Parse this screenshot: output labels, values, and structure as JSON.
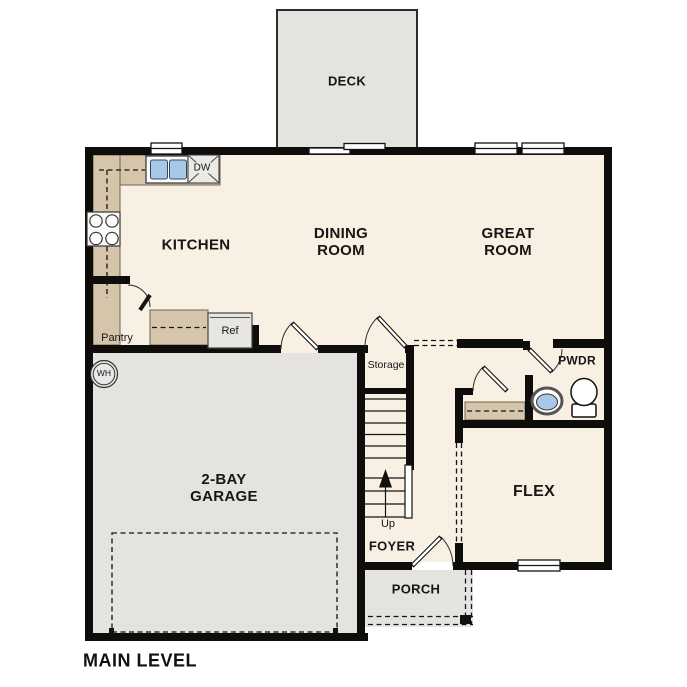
{
  "title": "MAIN LEVEL",
  "colors": {
    "wall": "#0f0d0c",
    "floor": "#f8f0e2",
    "concrete": "#e4e3e0",
    "counter": "#d5c5aa",
    "fixture_blue": "#a9c8e8"
  },
  "rooms": {
    "deck": "DECK",
    "kitchen": "KITCHEN",
    "dining": "DINING ROOM",
    "great": "GREAT ROOM",
    "pwdr": "PWDR",
    "flex": "FLEX",
    "foyer": "FOYER",
    "porch": "PORCH",
    "garage": "2-BAY GARAGE"
  },
  "annotations": {
    "pantry": "Pantry",
    "ref": "Ref",
    "dw": "DW",
    "wh": "WH",
    "storage": "Storage",
    "up": "Up"
  }
}
